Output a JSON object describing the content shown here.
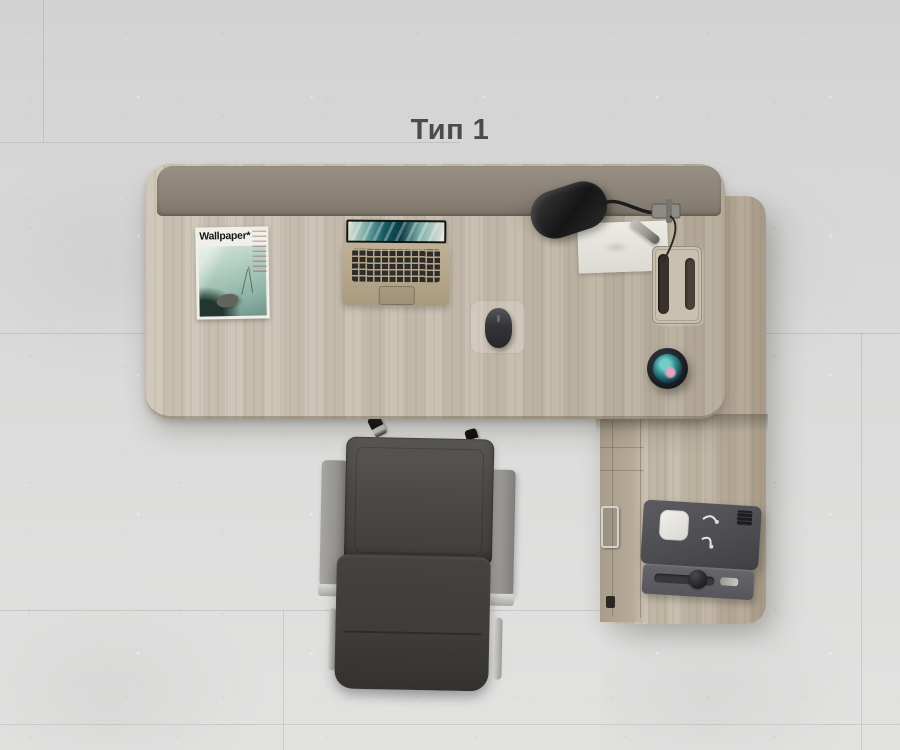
{
  "scene": {
    "title": "Тип 1",
    "objects": {
      "magazine": {
        "masthead": "Wallpaper*"
      },
      "desk": "l-shaped-desk-top-view",
      "return_unit": "return-cabinet-with-drawers",
      "lamp": "black-clamp-desk-lamp",
      "laptop": "gold-laptop-open",
      "notepad": "white-notepad-with-pen",
      "mouse": "dark-mouse-on-clear-pad",
      "smart_speaker": "round-smart-speaker-teal-pink-display",
      "grommet": "rectangular-cable-grommet",
      "printer": "gray-desktop-printer",
      "chair": "dark-leather-office-chair-top-view"
    }
  },
  "colors": {
    "title_text": "#4b4b4b",
    "desk_wood": "#c6bdae",
    "desk_wood_dark": "#b4aa99",
    "return_wood": "#c2b8a7",
    "modesty_panel": "#8b8277",
    "chair_upholstery": "#3f3c39",
    "chair_armrest": "#96948f",
    "lamp_black": "#151515",
    "laptop_gold": "#b3a489",
    "screen_teal": "#145b63",
    "speaker_teal": "#74ccc6",
    "speaker_pink": "#e5a3c2",
    "printer_gray": "#4d4d52",
    "paper_white": "#eceae4",
    "magazine_cover_green": "#a9c8bb"
  }
}
